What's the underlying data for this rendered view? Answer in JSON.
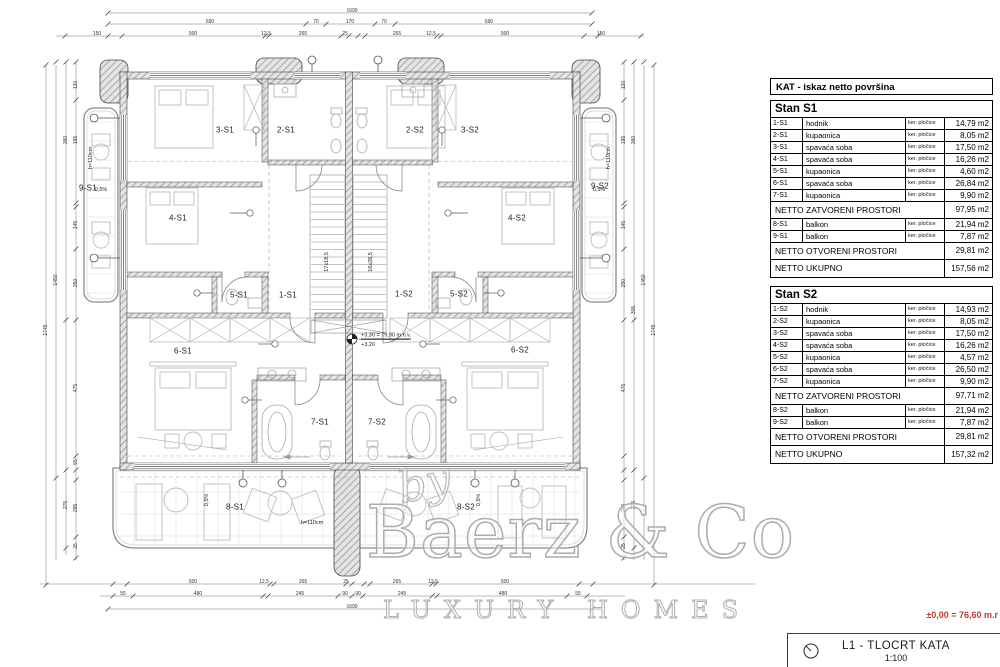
{
  "colors": {
    "accent_red": "#c23b31",
    "wall_line": "#444444",
    "furniture": "#bdbdbd",
    "dim_line": "#666666"
  },
  "legend": {
    "header": "KAT - iskaz netto površina"
  },
  "apartments": [
    {
      "name": "Stan S1",
      "rows": [
        {
          "code": "1-S1",
          "label": "hodnik",
          "finish": "ker. pločice",
          "area": "14,79 m2"
        },
        {
          "code": "2-S1",
          "label": "kupaonica",
          "finish": "ker. pločice",
          "area": "8,05 m2"
        },
        {
          "code": "3-S1",
          "label": "spavaća soba",
          "finish": "ker. pločice",
          "area": "17,50 m2"
        },
        {
          "code": "4-S1",
          "label": "spavaća soba",
          "finish": "ker. pločice",
          "area": "16,26 m2"
        },
        {
          "code": "5-S1",
          "label": "kupaonica",
          "finish": "ker. pločice",
          "area": "4,60 m2"
        },
        {
          "code": "6-S1",
          "label": "spavaća soba",
          "finish": "ker. pločice",
          "area": "26,84 m2"
        },
        {
          "code": "7-S1",
          "label": "kupaonica",
          "finish": "ker. pločice",
          "area": "9,90 m2"
        }
      ],
      "subtotal_closed": {
        "label": "NETTO ZATVORENI PROSTORI",
        "area": "97,95 m2"
      },
      "balcony_rows": [
        {
          "code": "8-S1",
          "label": "balkon",
          "finish": "ker. pločice",
          "area": "21,94 m2"
        },
        {
          "code": "9-S1",
          "label": "balkon",
          "finish": "ker. pločice",
          "area": "7,87 m2"
        }
      ],
      "subtotal_open": {
        "label": "NETTO OTVORENI PROSTORI",
        "area": "29,81 m2"
      },
      "total": {
        "label": "NETTO UKUPNO",
        "area": "157,56 m2"
      }
    },
    {
      "name": "Stan S2",
      "rows": [
        {
          "code": "1-S2",
          "label": "hodnik",
          "finish": "ker. pločice",
          "area": "14,93 m2"
        },
        {
          "code": "2-S2",
          "label": "kupaonica",
          "finish": "ker. pločice",
          "area": "8,05 m2"
        },
        {
          "code": "3-S2",
          "label": "spavaća soba",
          "finish": "ker. pločice",
          "area": "17,50 m2"
        },
        {
          "code": "4-S2",
          "label": "spavaća soba",
          "finish": "ker. pločice",
          "area": "16,26 m2"
        },
        {
          "code": "5-S2",
          "label": "kupaonica",
          "finish": "ker. pločice",
          "area": "4,57 m2"
        },
        {
          "code": "6-S2",
          "label": "spavaća soba",
          "finish": "ker. pločice",
          "area": "26,50 m2"
        },
        {
          "code": "7-S2",
          "label": "kupaonica",
          "finish": "ker. pločice",
          "area": "9,90 m2"
        }
      ],
      "subtotal_closed": {
        "label": "NETTO ZATVORENI PROSTORI",
        "area": "97,71 m2"
      },
      "balcony_rows": [
        {
          "code": "8-S2",
          "label": "balkon",
          "finish": "ker. pločice",
          "area": "21,94 m2"
        },
        {
          "code": "9-S2",
          "label": "balkon",
          "finish": "ker. pločice",
          "area": "7,87 m2"
        }
      ],
      "subtotal_open": {
        "label": "NETTO OTVORENI PROSTORI",
        "area": "29,81 m2"
      },
      "total": {
        "label": "NETTO UKUPNO",
        "area": "157,32 m2"
      }
    }
  ],
  "watermark": {
    "by": "by",
    "name": "Baerz & Co",
    "tagline": "LUXURY HOMES"
  },
  "title_block": {
    "level_note": "±0,00 = 76,60 m.r",
    "line1": "L1 -  TLOCRT KATA",
    "line2": "1:100"
  },
  "plan": {
    "rooms": [
      {
        "id": "3-S1",
        "x": 225,
        "y": 130
      },
      {
        "id": "2-S1",
        "x": 286,
        "y": 130
      },
      {
        "id": "2-S2",
        "x": 415,
        "y": 130
      },
      {
        "id": "3-S2",
        "x": 470,
        "y": 130
      },
      {
        "id": "9-S1",
        "x": 88,
        "y": 188
      },
      {
        "id": "9-S2",
        "x": 600,
        "y": 186
      },
      {
        "id": "4-S1",
        "x": 178,
        "y": 218
      },
      {
        "id": "4-S2",
        "x": 517,
        "y": 218
      },
      {
        "id": "5-S1",
        "x": 239,
        "y": 295
      },
      {
        "id": "1-S1",
        "x": 288,
        "y": 295
      },
      {
        "id": "1-S2",
        "x": 404,
        "y": 294
      },
      {
        "id": "5-S2",
        "x": 459,
        "y": 294
      },
      {
        "id": "6-S1",
        "x": 183,
        "y": 351
      },
      {
        "id": "6-S2",
        "x": 520,
        "y": 350
      },
      {
        "id": "7-S1",
        "x": 320,
        "y": 422
      },
      {
        "id": "7-S2",
        "x": 377,
        "y": 422
      },
      {
        "id": "8-S1",
        "x": 235,
        "y": 507
      },
      {
        "id": "8-S2",
        "x": 466,
        "y": 507
      }
    ],
    "annotations": [
      {
        "t": "+3,30 = 79,90 m.n.v.",
        "x": 361,
        "y": 336,
        "a": "l",
        "u": 1
      },
      {
        "t": "+3,20",
        "x": 361,
        "y": 345,
        "a": "l"
      },
      {
        "t": "h=110cm",
        "x": 91,
        "y": 158,
        "r": -90
      },
      {
        "t": "h=110cm",
        "x": 609,
        "y": 158,
        "r": -90
      },
      {
        "t": "h=110cm",
        "x": 312,
        "y": 523
      },
      {
        "t": "0,5%",
        "x": 101,
        "y": 190
      },
      {
        "t": "0,5%",
        "x": 599,
        "y": 190
      },
      {
        "t": "0,5%",
        "x": 207,
        "y": 500,
        "r": -90
      },
      {
        "t": "0,5%",
        "x": 479,
        "y": 500,
        "r": -90
      },
      {
        "t": "17x18,5",
        "x": 327,
        "y": 262,
        "r": -90
      },
      {
        "t": "16x28,5",
        "x": 371,
        "y": 262,
        "r": -90
      }
    ],
    "dimensions": [
      {
        "t": "1690",
        "x": 352,
        "y": 11
      },
      {
        "t": "690",
        "x": 210,
        "y": 22
      },
      {
        "t": "70",
        "x": 316,
        "y": 22
      },
      {
        "t": "170",
        "x": 350,
        "y": 22
      },
      {
        "t": "70",
        "x": 384,
        "y": 22
      },
      {
        "t": "690",
        "x": 489,
        "y": 22
      },
      {
        "t": "150",
        "x": 97,
        "y": 34
      },
      {
        "t": "500",
        "x": 193,
        "y": 34
      },
      {
        "t": "12,5",
        "x": 266,
        "y": 34
      },
      {
        "t": "265",
        "x": 303,
        "y": 34
      },
      {
        "t": "25",
        "x": 345,
        "y": 34
      },
      {
        "t": "265",
        "x": 397,
        "y": 34
      },
      {
        "t": "12,5",
        "x": 431,
        "y": 34
      },
      {
        "t": "500",
        "x": 505,
        "y": 34
      },
      {
        "t": "150",
        "x": 601,
        "y": 34
      },
      {
        "t": "500",
        "x": 193,
        "y": 582
      },
      {
        "t": "12,5",
        "x": 264,
        "y": 582
      },
      {
        "t": "265",
        "x": 303,
        "y": 582
      },
      {
        "t": "25",
        "x": 346,
        "y": 582
      },
      {
        "t": "265",
        "x": 397,
        "y": 582
      },
      {
        "t": "12,5",
        "x": 433,
        "y": 582
      },
      {
        "t": "500",
        "x": 505,
        "y": 582
      },
      {
        "t": "55",
        "x": 123,
        "y": 594
      },
      {
        "t": "480",
        "x": 198,
        "y": 594
      },
      {
        "t": "245",
        "x": 300,
        "y": 594
      },
      {
        "t": "90",
        "x": 345,
        "y": 594
      },
      {
        "t": "90",
        "x": 358,
        "y": 594
      },
      {
        "t": "245",
        "x": 402,
        "y": 594
      },
      {
        "t": "480",
        "x": 503,
        "y": 594
      },
      {
        "t": "55",
        "x": 578,
        "y": 594
      },
      {
        "t": "1690",
        "x": 352,
        "y": 607
      },
      {
        "t": "120",
        "x": 76,
        "y": 85,
        "r": -90
      },
      {
        "t": "195",
        "x": 76,
        "y": 140,
        "r": -90
      },
      {
        "t": "145",
        "x": 76,
        "y": 225,
        "r": -90
      },
      {
        "t": "250",
        "x": 76,
        "y": 283,
        "r": -90
      },
      {
        "t": "475",
        "x": 76,
        "y": 388,
        "r": -90
      },
      {
        "t": "55",
        "x": 76,
        "y": 462,
        "r": -90
      },
      {
        "t": "295",
        "x": 76,
        "y": 508,
        "r": -90
      },
      {
        "t": "25",
        "x": 76,
        "y": 546,
        "r": -90
      },
      {
        "t": "360",
        "x": 66,
        "y": 140,
        "r": -90
      },
      {
        "t": "275",
        "x": 66,
        "y": 505,
        "r": -90
      },
      {
        "t": "1450",
        "x": 56,
        "y": 280,
        "r": -90
      },
      {
        "t": "1745",
        "x": 46,
        "y": 330,
        "r": -90
      },
      {
        "t": "120",
        "x": 624,
        "y": 85,
        "r": -90
      },
      {
        "t": "195",
        "x": 624,
        "y": 140,
        "r": -90
      },
      {
        "t": "145",
        "x": 624,
        "y": 225,
        "r": -90
      },
      {
        "t": "250",
        "x": 624,
        "y": 283,
        "r": -90
      },
      {
        "t": "475",
        "x": 624,
        "y": 388,
        "r": -90
      },
      {
        "t": "296",
        "x": 624,
        "y": 508,
        "r": -90
      },
      {
        "t": "25",
        "x": 624,
        "y": 546,
        "r": -90
      },
      {
        "t": "360",
        "x": 634,
        "y": 140,
        "r": -90
      },
      {
        "t": "305",
        "x": 634,
        "y": 310,
        "r": -90
      },
      {
        "t": "275",
        "x": 634,
        "y": 505,
        "r": -90
      },
      {
        "t": "1450",
        "x": 644,
        "y": 280,
        "r": -90
      },
      {
        "t": "1745",
        "x": 654,
        "y": 330,
        "r": -90
      }
    ]
  }
}
